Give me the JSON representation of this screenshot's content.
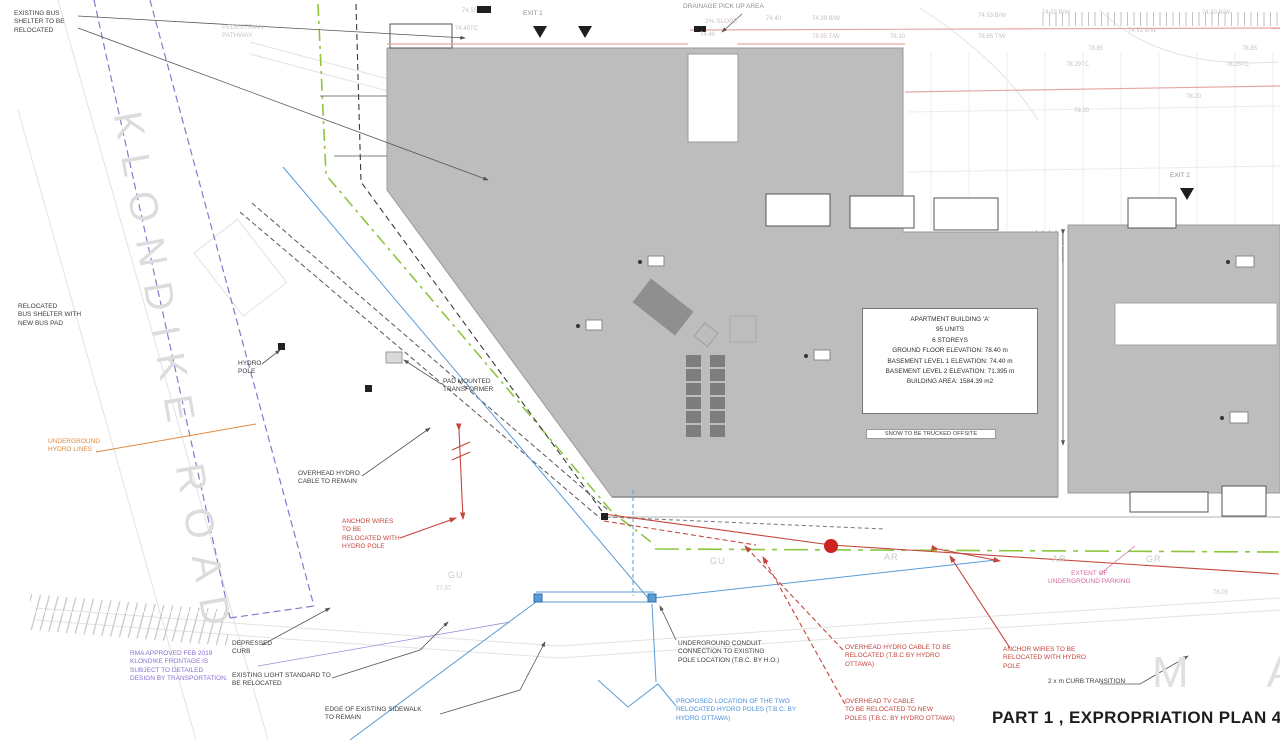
{
  "title": "PART 1 , EXPROPRIATION PLAN 4",
  "streets": {
    "left": "KLONDIKE ROAD",
    "bottom": "M A"
  },
  "building_label": "APARTMENT BUILDING 'A'\n95 UNITS\n6 STOREYS\nGROUND FLOOR ELEVATION: 78.40 m\nBASEMENT LEVEL 1 ELEVATION: 74.40 m\nBASEMENT LEVEL 2 ELEVATION: 71.395 m\nBUILDING AREA: 1584.39 m2",
  "snow_note": "SNOW TO BE TRUCKED OFFSITE",
  "exits": {
    "exit1": "EXIT 1",
    "exit2": "EXIT 2"
  },
  "notes": {
    "bus_existing": "EXISTING BUS\nSHELTER TO BE\nRELOCATED",
    "pedestrian": "PEDESTRIAN\nPATHWAY",
    "bus_relocated": "RELOCATED\nBUS SHELTER WITH\nNEW BUS PAD",
    "hydro_pole": "HYDRO\nPOLE",
    "pad_transformer": "PAD MOUNTED\nTRANSFORMER",
    "underground_hydro": "UNDERGROUND\nHYDRO LINES",
    "overhead_remain": "OVERHEAD HYDRO\nCABLE TO REMAIN",
    "anchor_left": "ANCHOR WIRES\nTO BE\nRELOCATED WITH\nHYDRO POLE",
    "rma": "RMA APPROVED FEB 2019\nKLONDIKE FRONTAGE IS\nSUBJECT TO DETAILED\nDESIGN BY TRANSPORTATION.",
    "depressed_curb": "DEPRESSED\nCURB",
    "light_standard": "EXISTING LIGHT STANDARD TO\nBE RELOCATED",
    "sidewalk_edge": "EDGE OF EXISTING SIDEWALK\nTO REMAIN",
    "conduit": "UNDERGROUND CONDUIT\nCONNECTION TO EXISTING\nPOLE LOCATION (T.B.C. BY H.O.)",
    "proposed_poles": "PROPOSED LOCATION OF THE TWO\nRELOCATED HYDRO POLES (T.B.C. BY\nHYDRO OTTAWA)",
    "overhead_relocate": "OVERHEAD HYDRO CABLE TO BE\nRELOCATED (T.B.C BY HYDRO\nOTTAWA)",
    "tv_cable": "OVERHEAD TV CABLE\nTO BE RELOCATED TO NEW\nPOLES (T.B.C. BY HYDRO OTTAWA)",
    "anchor_right": "ANCHOR WIRES TO BE\nRELOCATED WITH HYDRO\nPOLE",
    "curb_transition": "2 x m CURB TRANSITION",
    "extent_parking": "EXTENT OF\nUNDERGROUND PARKING",
    "drainage": "DRAINAGE PICK UP AREA",
    "slope": "2% SLOPE"
  },
  "elev": {
    "e1": "74.55",
    "e2": "74.45TC",
    "e3": "74.40",
    "e4": "74.40",
    "e5": "74.39 B/W",
    "e6": "78.95 T/W",
    "e7": "78.10",
    "e8": "78.85 T/W",
    "e9": "74.53 B/W",
    "e10": "74.53 B/W",
    "e11": "74.50 B/W",
    "e12": "74.53 B/W",
    "e13": "78.85",
    "e14": "78.85",
    "e15": "78.29TC",
    "e16": "78.25TC",
    "e17": "78.20",
    "e18": "78.10",
    "e19": "78.05",
    "e20": "77.97"
  },
  "zones": {
    "gu1": "GU",
    "gu2": "GU",
    "ar1": "AR",
    "ar2": "AR",
    "gr": "GR"
  },
  "colors": {
    "building_fill": "#bdbdbd",
    "expropriation_purple": "#8878cc",
    "hydro_green": "#8cc63f",
    "proposed_blue": "#5b9bd5",
    "relocate_red": "#c4453c",
    "note_purple": "#8a6fd0",
    "note_orange": "#e08a3c",
    "note_pink": "#d4679f"
  }
}
